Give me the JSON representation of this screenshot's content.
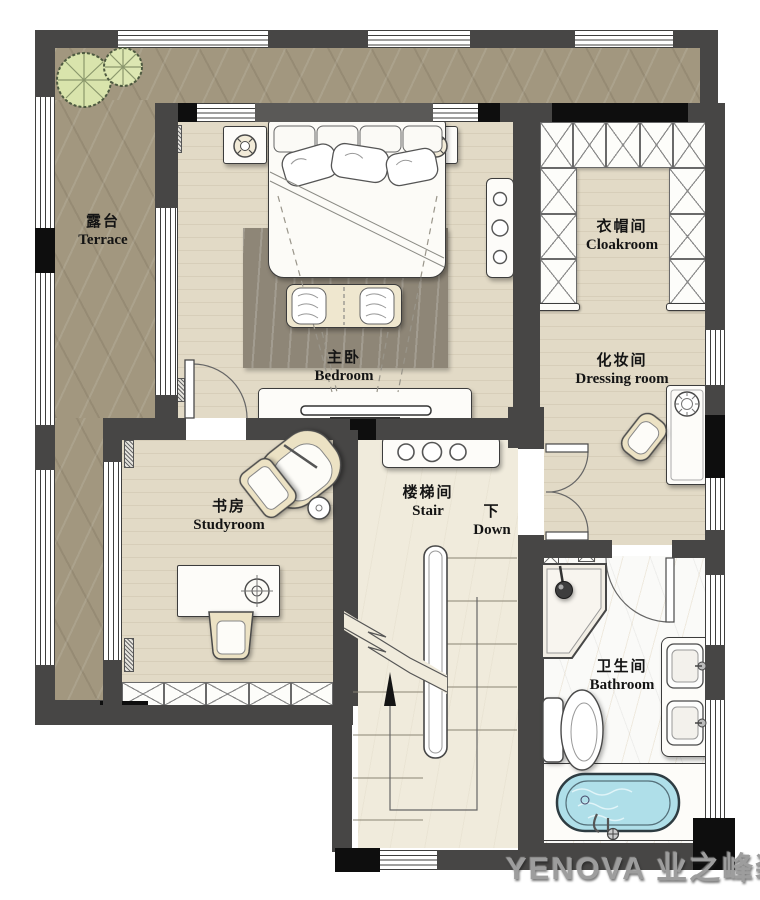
{
  "rooms": {
    "terrace": {
      "zh": "露台",
      "en": "Terrace"
    },
    "bedroom": {
      "zh": "主卧",
      "en": "Bedroom"
    },
    "cloakroom": {
      "zh": "衣帽间",
      "en": "Cloakroom"
    },
    "dressing": {
      "zh": "化妆间",
      "en": "Dressing room"
    },
    "study": {
      "zh": "书房",
      "en": "Studyroom"
    },
    "stair": {
      "zh": "楼梯间",
      "en": "Stair"
    },
    "bathroom": {
      "zh": "卫生间",
      "en": "Bathroom"
    }
  },
  "stair_down": {
    "zh": "下",
    "en": "Down"
  },
  "watermark": "YENOVA 业之峰装",
  "colors": {
    "wall": "#474645",
    "wall_black": "#0e0e0e",
    "floor_wood": "#e2dac6",
    "floor_stair": "#f0ebdc",
    "floor_bath": "#fafaf8",
    "terrace_stone": "#a2977f",
    "water": "#afdfe9",
    "plant": "#d9e4ac",
    "furniture_cream": "#ece2c8"
  }
}
